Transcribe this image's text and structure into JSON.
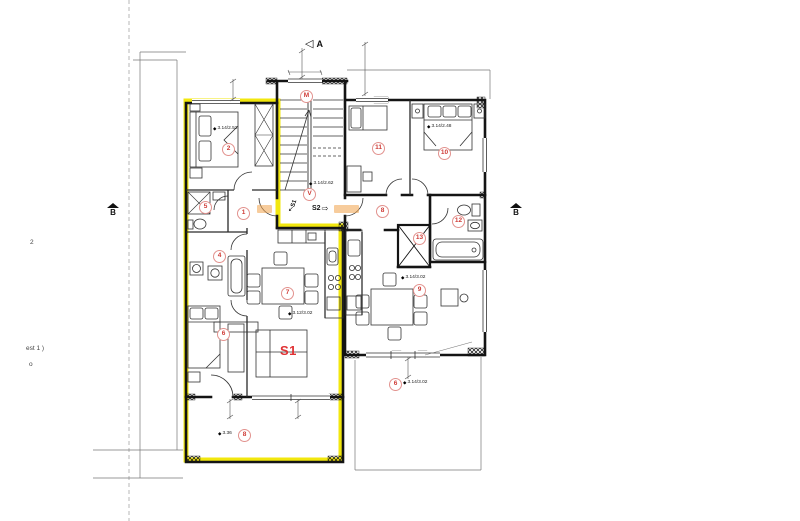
{
  "plan": {
    "section_markers": {
      "a": "A",
      "b_left": "B",
      "b_right": "B"
    },
    "unit_labels": {
      "s1_main": "S1",
      "s1_entry": "S1",
      "s2_entry": "S2"
    },
    "icons": {
      "section_a_arrow": "◁",
      "s2_entry_arrow": "⇨",
      "s1_entry_arrow": "↙",
      "level_symbol": "◆"
    },
    "margin_notes": {
      "top": "2",
      "middle": "est 1 )",
      "bottom": "o"
    },
    "room_numbers": {
      "s1_hall": "1",
      "s1_bedroom1": "2",
      "s1_bathroom": "4",
      "s1_wc": "5",
      "s1_bedroom2": "6",
      "s1_living": "7",
      "s1_terrace": "8",
      "stair_upper": "M",
      "stair_lower": "V",
      "s2_hall": "8",
      "s2_living": "9",
      "s2_bedroom1": "10",
      "s2_bedroom2": "11",
      "s2_bathroom": "12",
      "s2_wc": "13",
      "s2_terrace": "6"
    },
    "level_markers": {
      "s1_bedroom1": "3.14/2.52",
      "stairs": "3.14/2.62",
      "s2_bedroom1": "3.14/2.48",
      "s1_living": "3.12/3.02",
      "s2_living": "3.14/3.02",
      "s2_terrace": "3.14/3.02",
      "s1_terrace": "3.36"
    },
    "colors": {
      "highlight_yellow": "#f2e70e",
      "marker_red": "#cf3b36",
      "unit_red": "#e03234",
      "accent_orange": "#f0a24a"
    }
  }
}
